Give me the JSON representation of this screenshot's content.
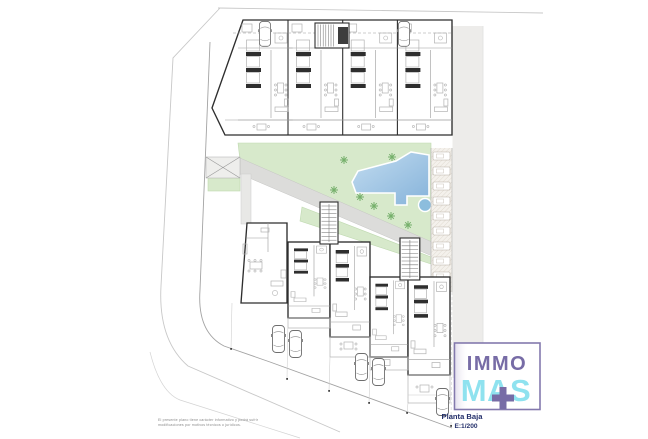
{
  "page": {
    "width": 648,
    "height": 439,
    "background": "#ffffff"
  },
  "colors": {
    "wall": "#2e2e2e",
    "light_line": "#9a9a9a",
    "furniture": "#b3b3b3",
    "street": "#c8c8c8",
    "boundary": "#a3a3a3",
    "sidewalk": "#edecea",
    "lawn": "#d7e9cb",
    "lawn_edge": "#bfd9b0",
    "tree": "#76b06b",
    "pool_light": "#c2dcf0",
    "pool_dark": "#86b3da",
    "pool_spa": "#8cbddd",
    "walkway": "#dcdcda",
    "hatch_bg": "#f4f1ec",
    "hatch_line": "#d8d1c6",
    "logo_purple": "#776ca6",
    "logo_cyan": "#8fe2ef",
    "logo_border": "#8379ad",
    "title_navy": "#232f6a",
    "disclaimer_gray": "#8a8a8a"
  },
  "plan": {
    "title": "Planta Baja",
    "scale": "E:1/200"
  },
  "disclaimer": {
    "line1": "El presente plano tiene carácter informativo y podrá sufrir",
    "line2": "modificaciones por motivos técnicos o jurídicos."
  },
  "logo": {
    "immo": "IMMO",
    "mas": "MAS",
    "plus_icon": "+"
  },
  "site": {
    "top_units": 4,
    "bottom_units": 5,
    "parking_stalls": 9,
    "trees": 8,
    "cars": 7,
    "pools": 2,
    "stair_towers": 3
  }
}
